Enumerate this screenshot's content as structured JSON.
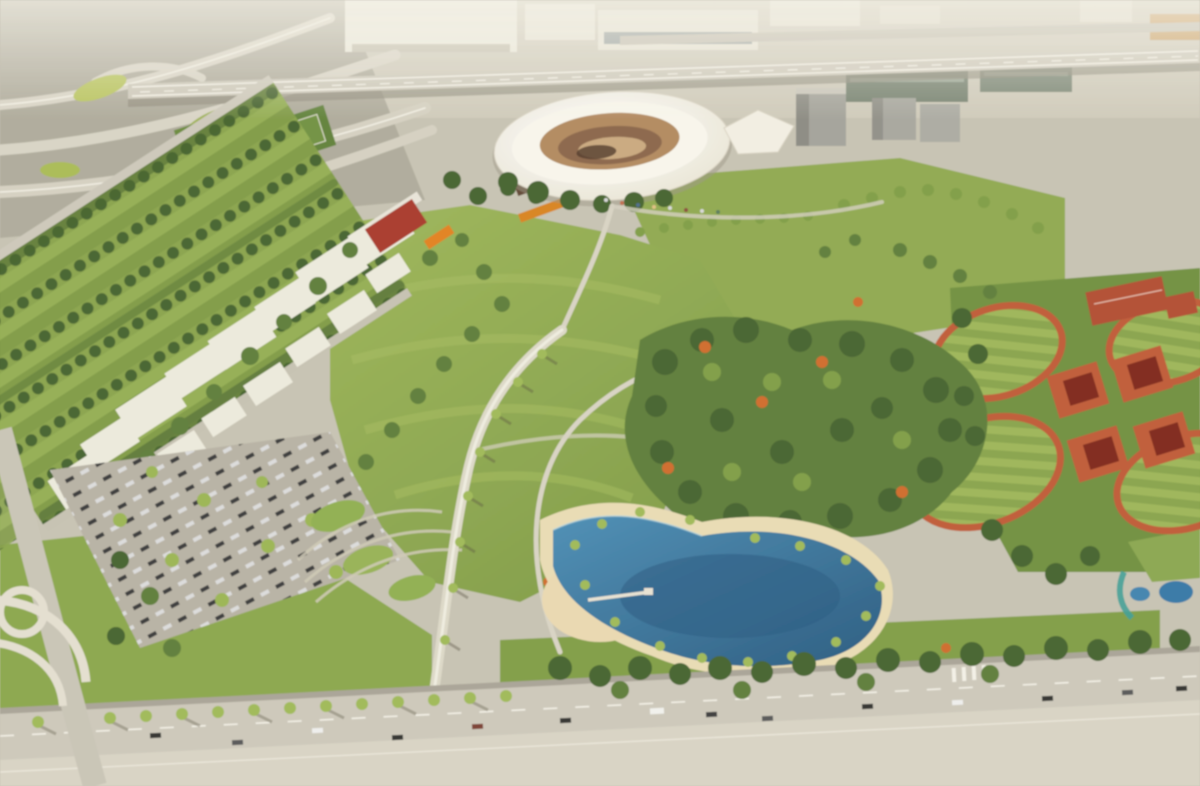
{
  "image": {
    "kind": "architectural aerial rendering",
    "description": "Aerial rendering of a planned stadium park: white soccer stadium beside highways, tech-hub campus buildings, tree nursery rows, a great lawn with winding promenades, dense park forest with flowering trees, a blue swimming lagoon with sand beach, red-roofed ball-field complex, surface parking and a palm-lined boulevard with traffic",
    "width_px": 1200,
    "height_px": 786,
    "visible_text": "none"
  },
  "palette": {
    "ground_concrete": "#c7c2b3",
    "ground_light": "#d8d3c5",
    "haze_white": "#f1eee4",
    "building_white": "#edeadd",
    "building_side": "#a9a69a",
    "building_glass": "#75806f",
    "building_amber": "#c89858",
    "office_gray": "#a3a29a",
    "road_light": "#cdc8ba",
    "road_shadow": "#95907f",
    "lane_white": "#f4f1e7",
    "grass_mid": "#8aa64a",
    "grass_light": "#9cb457",
    "grass_dark": "#6f8f3e",
    "pitch_green": "#5f8038",
    "tree_dark": "#44602c",
    "tree_mid": "#5d7c38",
    "tree_light": "#7e9c44",
    "tree_yellow": "#a8bf5d",
    "tree_orange": "#cf6a2a",
    "palm_green": "#9fb955",
    "trunk_brown": "#8a7a5a",
    "path_light": "#ddd8c8",
    "sand": "#e9dcb4",
    "water_mid": "#3f82ae",
    "water_deep": "#27587f",
    "water_teal": "#3e9e95",
    "stadium_shell": "#f7f3e8",
    "stadium_seats": "#b2885e",
    "stadium_bowl": "#8a6548",
    "red_building": "#a83828",
    "orange_canopy": "#e2801f",
    "clay_red": "#bf5a35",
    "court_red": "#b14a30",
    "pavilion_red": "#7e2417",
    "car_dark": "#2e2e2e",
    "car_white": "#efefee"
  },
  "scene": {
    "landmarks": [
      "highway interchange",
      "elevated expressway",
      "industrial warehouses",
      "soccer stadium",
      "event pavilion",
      "office buildings",
      "tree nursery rows",
      "campus buildings",
      "red hall with orange canopy",
      "central great lawn",
      "winding promenade",
      "dense park forest",
      "flowering trees",
      "swimming lagoon with beach",
      "boardwalk dock",
      "terraced spiral garden",
      "surface parking",
      "ball field complex",
      "red shade pavilions",
      "sport courts",
      "boulevard with traffic",
      "palm tree rows"
    ]
  }
}
